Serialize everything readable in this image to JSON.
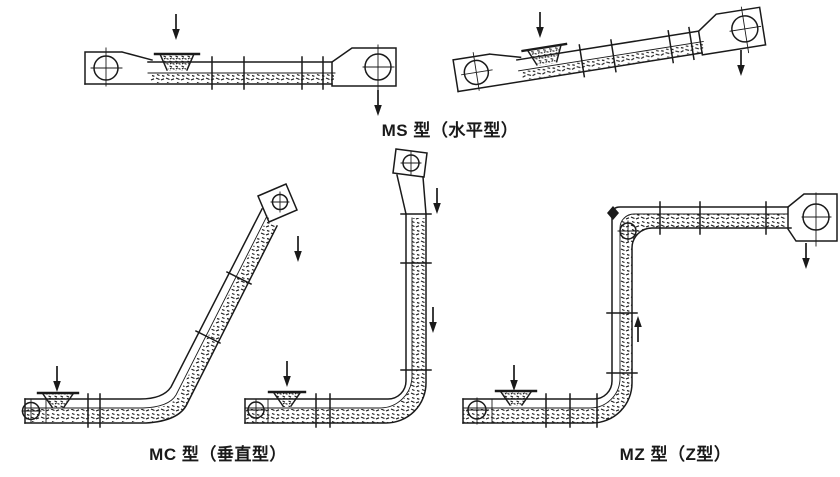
{
  "page": {
    "background_color": "#ffffff",
    "ink_color": "#1a1a1a"
  },
  "captions": {
    "ms": "MS 型（水平型）",
    "mc": "MC 型（垂直型）",
    "mz": "MZ 型（Z型）"
  }
}
